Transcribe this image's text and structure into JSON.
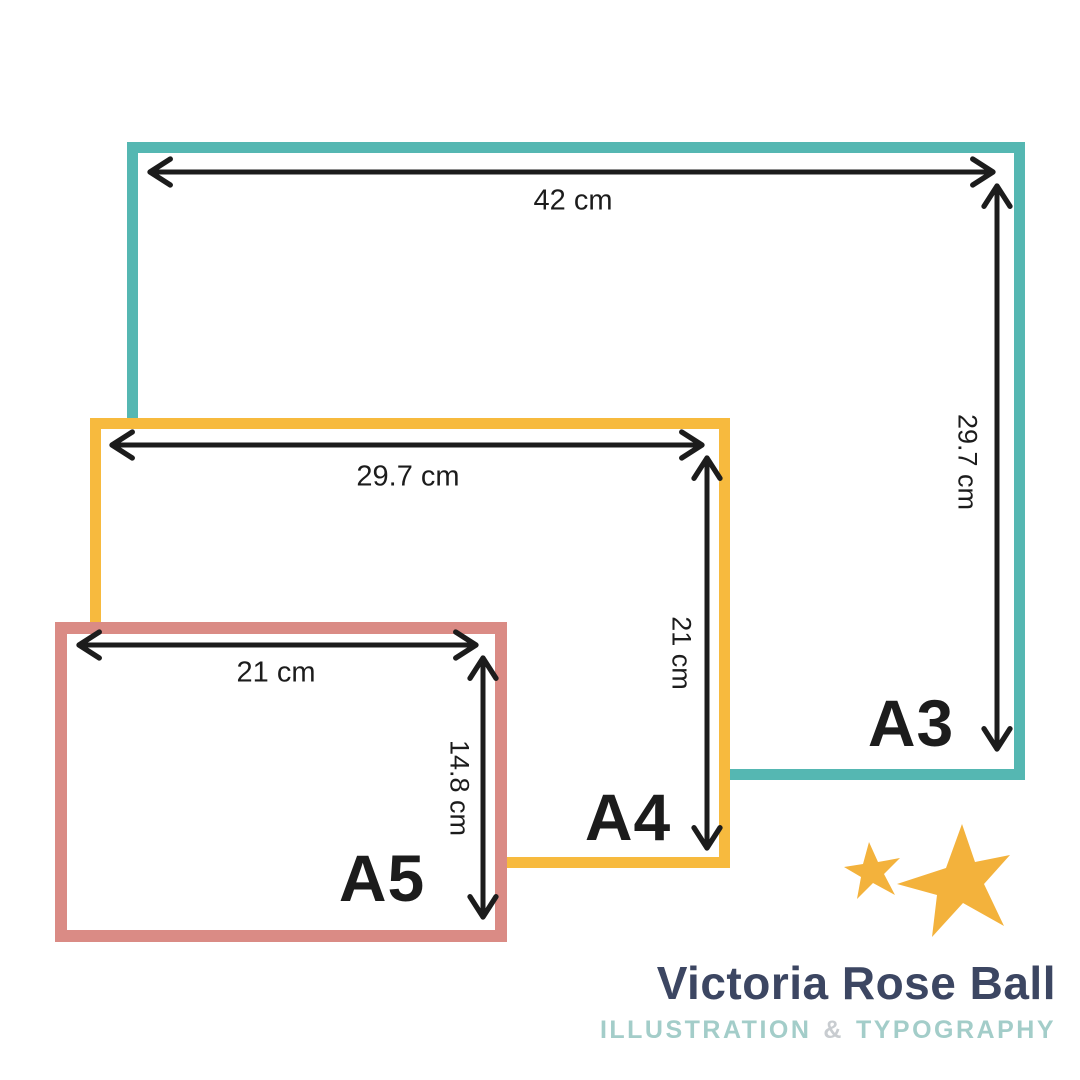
{
  "diagram": {
    "description": "Paper size comparison diagram",
    "arrow_color": "#1c1c1c",
    "sheets": [
      {
        "name": "A3",
        "width_label": "42 cm",
        "height_label": "29.7 cm",
        "border_color": "#55b7b2"
      },
      {
        "name": "A4",
        "width_label": "29.7 cm",
        "height_label": "21 cm",
        "border_color": "#f7ba3e"
      },
      {
        "name": "A5",
        "width_label": "21 cm",
        "height_label": "14.8 cm",
        "border_color": "#da8b85"
      }
    ]
  },
  "icons": {
    "stars": [
      "small-star-icon",
      "large-star-icon"
    ],
    "star_color": "#f3b23c"
  },
  "signature": {
    "name": "Victoria Rose Ball",
    "subtitle_part1": "ILLUSTRATION",
    "ampersand": "&",
    "subtitle_part2": "TYPOGRAPHY",
    "name_color": "#3c4662",
    "subtitle_color": "#a3cdc9"
  }
}
